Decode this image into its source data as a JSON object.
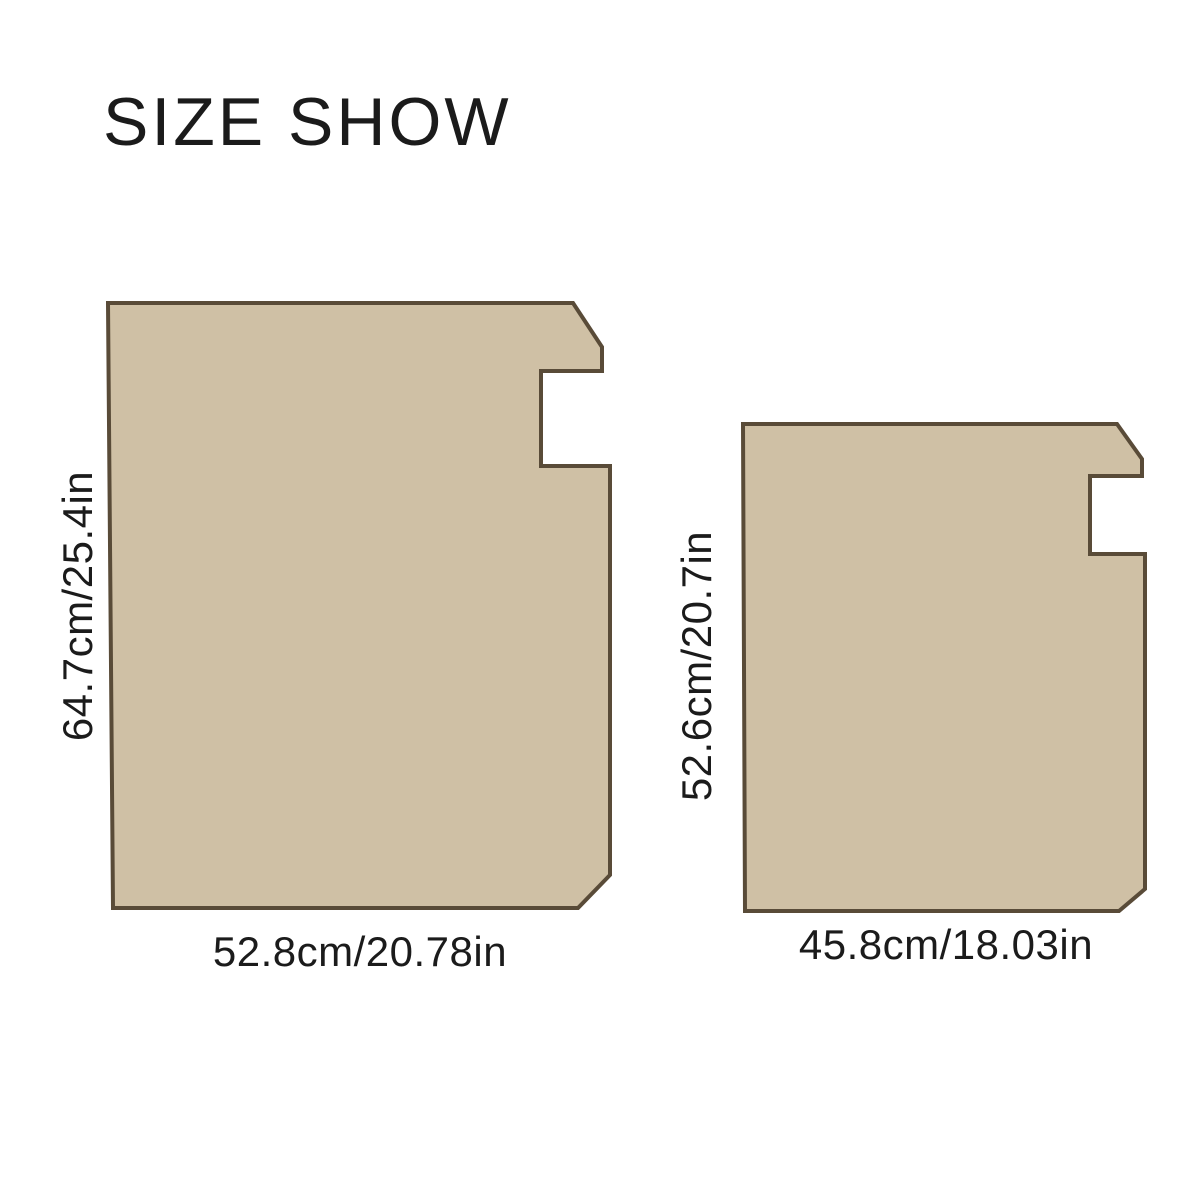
{
  "title": "SIZE SHOW",
  "colors": {
    "mat_fill": "#cfc0a5",
    "mat_outline": "#594b38",
    "text": "#1b1b1b",
    "background": "#ffffff"
  },
  "mats": {
    "large": {
      "height_label": "64.7cm/25.4in",
      "width_label": "52.8cm/20.78in"
    },
    "small": {
      "height_label": "52.6cm/20.7in",
      "width_label": "45.8cm/18.03in"
    }
  }
}
